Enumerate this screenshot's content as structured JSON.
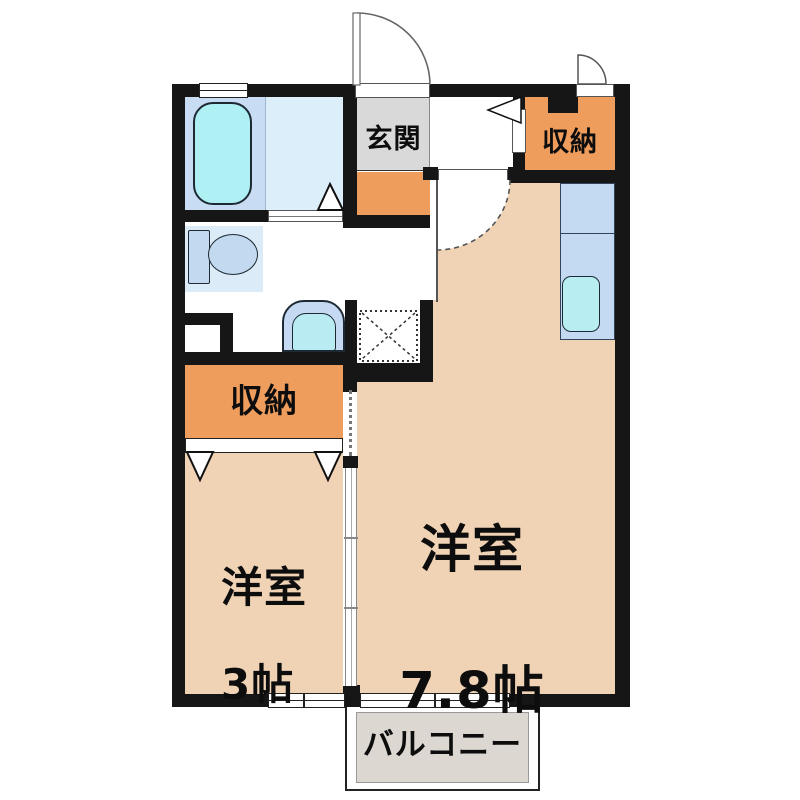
{
  "floor_plan": {
    "type": "japanese-apartment-floorplan",
    "labels": {
      "entrance": "玄関",
      "storage_top_right": "収納",
      "storage_left": "収納",
      "main_room_name": "洋室",
      "main_room_size": "7.8帖",
      "small_room_name": "洋室",
      "small_room_size": "3帖",
      "balcony": "バルコニー"
    },
    "rooms": [
      {
        "name": "entrance-genkan",
        "label": "玄関",
        "floor_color": "#d9d9d9"
      },
      {
        "name": "storage-top-right",
        "label": "収納",
        "floor_color": "#ee9d5d"
      },
      {
        "name": "storage-left",
        "label": "収納",
        "floor_color": "#ee9d5d"
      },
      {
        "name": "western-room-main",
        "label": "洋室 7.8帖",
        "floor_color": "#f0d2b4"
      },
      {
        "name": "western-room-small",
        "label": "洋室 3帖",
        "floor_color": "#f0d2b4"
      },
      {
        "name": "bathroom",
        "label": "",
        "floor_color": "#ddeefb"
      },
      {
        "name": "washroom-toilet",
        "label": "",
        "floor_color": "#ffffff"
      },
      {
        "name": "kitchen-counter",
        "label": "",
        "floor_color": "#c3daf2"
      },
      {
        "name": "balcony",
        "label": "バルコニー",
        "floor_color": "#dcd7d0"
      }
    ],
    "fixtures": [
      "bathtub-icon",
      "toilet-icon",
      "washbasin-icon",
      "kitchen-sink-icon",
      "washing-machine-space-icon",
      "entrance-door-icon",
      "room-door-icon",
      "exterior-storage-door-icon",
      "folding-door-triangle-icon",
      "sliding-partition-icon",
      "window-icon"
    ],
    "colors": {
      "wall": "#161616",
      "room_peach": "#f0d2b4",
      "storage_orange": "#ee9d5d",
      "entrance_gray": "#d9d9d9",
      "bath_floor_blue": "#ddeefb",
      "bath_panel_blue": "#c8ddf3",
      "fixture_blue": "#c3d9f0",
      "water_cyan": "#aff0f5",
      "kitchen_blue": "#c3daf2",
      "balcony_floor": "#dcd7d0"
    }
  }
}
